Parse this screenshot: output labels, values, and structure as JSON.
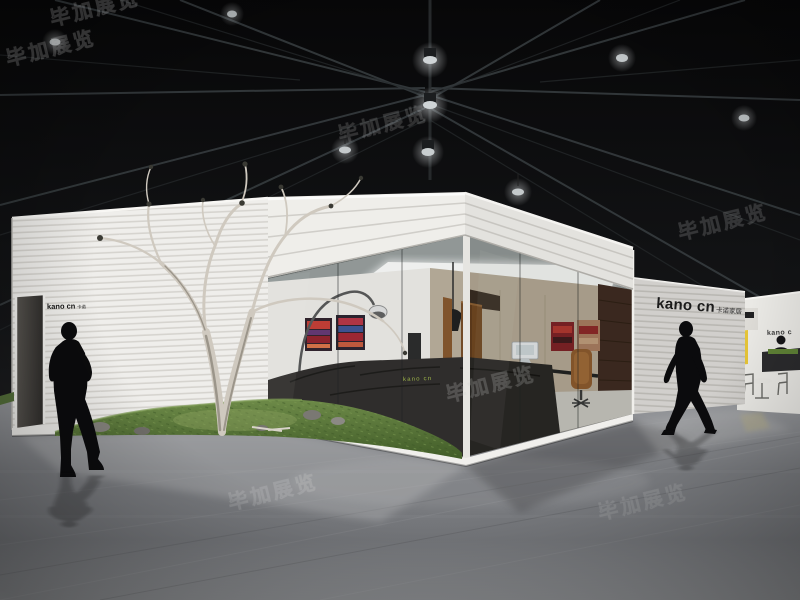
{
  "scene": {
    "setting": "dark exhibition hall with steel roof trusses and spotlights",
    "subject": "white minimalist exhibition booth with glass corner showroom, bare tree on grass mound, glossy grey floor, two walking silhouette figures"
  },
  "branding": {
    "main_logo_latin": "kano cn",
    "main_logo_cjk": "卡诺家居",
    "left_sign_latin": "kano cn",
    "left_sign_cjk": "卡诺",
    "neighbor_logo": "kano c",
    "counter_led_text": "kano cn"
  },
  "watermark": {
    "text": "毕加展览"
  },
  "palette": {
    "hall_dark": "#0e0e10",
    "truss_grey": "#3a4043",
    "wall_white": "#eeedea",
    "rib_shadow": "#d6d4cf",
    "glass_tint": "#aab4b0",
    "grass_green": "#5d7a3c",
    "tree_bark": "#cfc9bf",
    "painting_red": "#a02028",
    "wood_brown": "#6d4018",
    "accent_yellow": "#e5c437",
    "led_green": "#a3bd3f",
    "floor_grey": "#85878a",
    "silhouette_black": "#0b0b0d"
  }
}
